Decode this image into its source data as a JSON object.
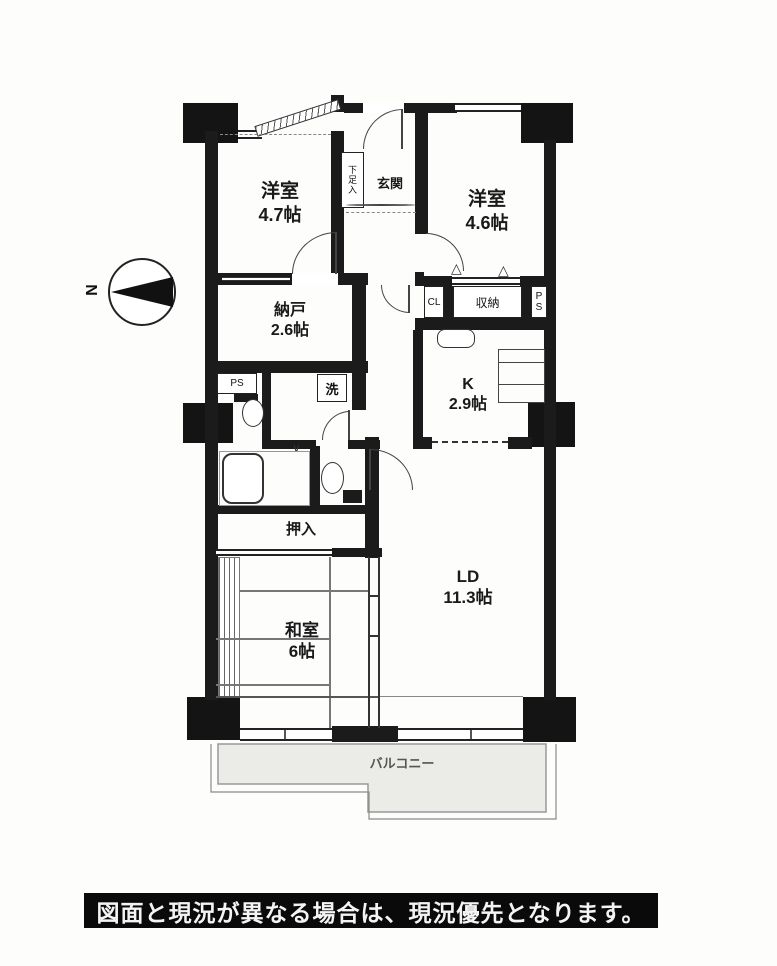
{
  "compass": {
    "north_label": "N"
  },
  "rooms": {
    "yoshitsu1": {
      "name": "洋室",
      "size": "4.7帖"
    },
    "genkan": {
      "name": "玄関"
    },
    "shoebox": {
      "name": "下足入"
    },
    "yoshitsu2": {
      "name": "洋室",
      "size": "4.6帖"
    },
    "nando": {
      "name": "納戸",
      "size": "2.6帖"
    },
    "cl": {
      "name": "CL"
    },
    "shuno": {
      "name": "収納"
    },
    "ps_right": {
      "line1": "P",
      "line2": "S"
    },
    "ps_left": {
      "name": "PS"
    },
    "kitchen": {
      "name": "K",
      "size": "2.9帖"
    },
    "laundry": {
      "name": "洗"
    },
    "oshiire": {
      "name": "押入"
    },
    "washitsu": {
      "name": "和室",
      "size": "6帖"
    },
    "ld": {
      "name": "LD",
      "size": "11.3帖"
    },
    "balcony": {
      "name": "バルコニー"
    }
  },
  "symbols": {
    "fold_door": "△",
    "swing_mark": "∨"
  },
  "colors": {
    "wall": "#1b1b1b",
    "balcony_fill": "#ebebe7",
    "bar_bg": "#0a0a0a",
    "bar_text": "#f4f4f4"
  },
  "disclaimer": "図面と現況が異なる場合は、現況優先となります。"
}
